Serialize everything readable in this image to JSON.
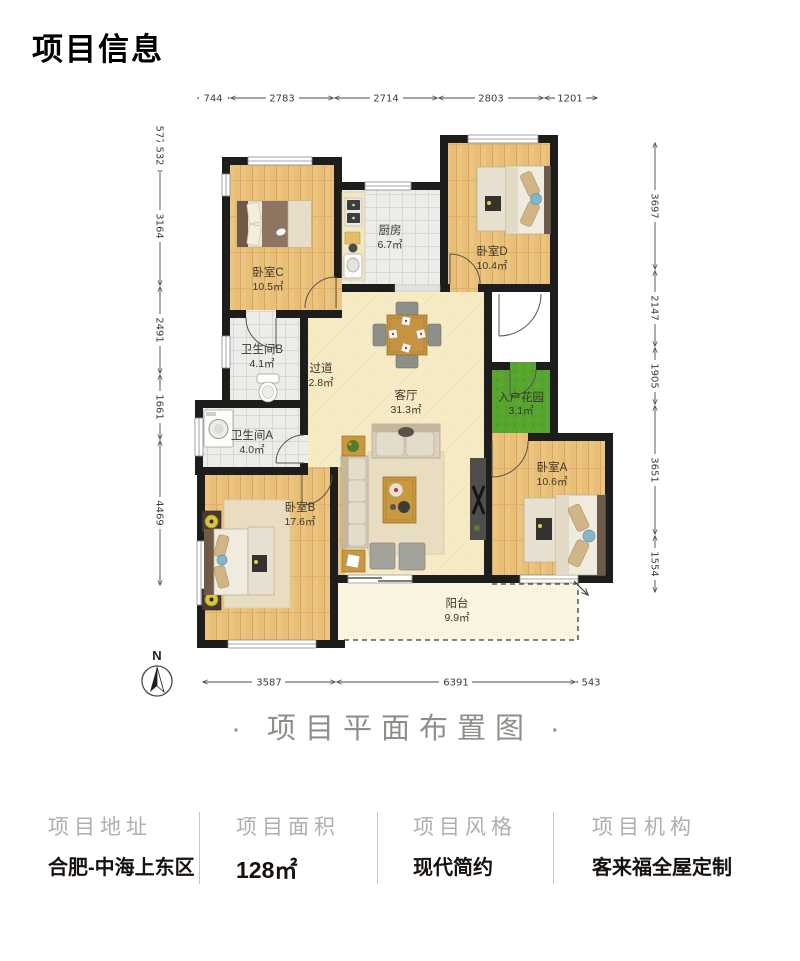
{
  "header": {
    "title": "项目信息"
  },
  "caption": "· 项目平面布置图 ·",
  "plan": {
    "rooms": [
      {
        "name": "卧室C",
        "area": "10.5㎡"
      },
      {
        "name": "厨房",
        "area": "6.7㎡"
      },
      {
        "name": "卧室D",
        "area": "10.4㎡"
      },
      {
        "name": "卫生间B",
        "area": "4.1㎡"
      },
      {
        "name": "过道",
        "area": "2.8㎡"
      },
      {
        "name": "客厅",
        "area": "31.3㎡"
      },
      {
        "name": "入户花园",
        "area": "3.1㎡"
      },
      {
        "name": "卫生间A",
        "area": "4.0㎡"
      },
      {
        "name": "卧室A",
        "area": "10.6㎡"
      },
      {
        "name": "卧室B",
        "area": "17.6㎡"
      },
      {
        "name": "阳台",
        "area": "9.9㎡"
      }
    ],
    "dimensions": {
      "top": [
        "744",
        "2783",
        "2714",
        "2803",
        "1201"
      ],
      "left": [
        "577",
        "532",
        "3164",
        "2491",
        "1661",
        "4469"
      ],
      "right": [
        "3697",
        "2147",
        "1905",
        "3651",
        "1554"
      ],
      "bottom": [
        "3587",
        "6391",
        "543"
      ]
    },
    "compass": {
      "label": "N"
    }
  },
  "info": {
    "columns": [
      {
        "label": "项目地址",
        "value": "合肥-中海上东区"
      },
      {
        "label": "项目面积",
        "value": "128㎡"
      },
      {
        "label": "项目风格",
        "value": "现代简约"
      },
      {
        "label": "项目机构",
        "value": "客来福全屋定制"
      }
    ]
  },
  "colors": {
    "wall": "#1d1d1b",
    "wood_floor": "#ecc481",
    "tile_floor": "#ececea",
    "living_floor": "#f7ebc6",
    "garden_green": "#57a52f",
    "balcony": "#f8f4df"
  }
}
